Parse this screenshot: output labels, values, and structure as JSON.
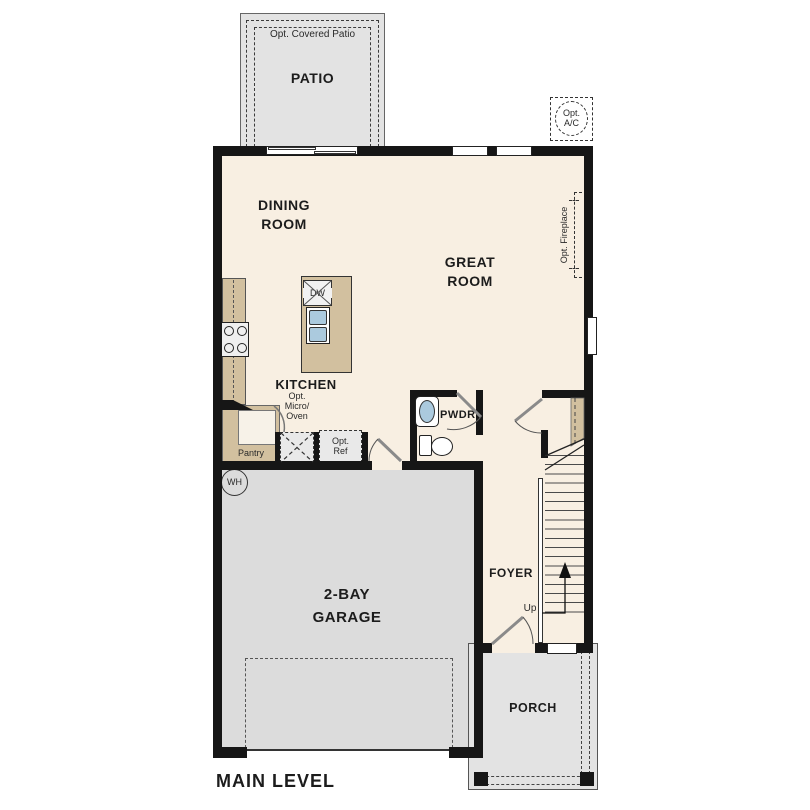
{
  "plan": {
    "title": "MAIN LEVEL",
    "rooms": {
      "patio": {
        "name": "PATIO",
        "option": "Opt. Covered Patio"
      },
      "dining_room": {
        "line1": "DINING",
        "line2": "ROOM"
      },
      "great_room": {
        "line1": "GREAT",
        "line2": "ROOM"
      },
      "kitchen": {
        "name": "KITCHEN"
      },
      "pantry": {
        "name": "Pantry"
      },
      "powder_room": {
        "name": "PWDR"
      },
      "foyer": {
        "name": "FOYER"
      },
      "garage": {
        "line1": "2-BAY",
        "line2": "GARAGE"
      },
      "porch": {
        "name": "PORCH"
      }
    },
    "features": {
      "opt_ac": {
        "line1": "Opt.",
        "line2": "A/C"
      },
      "opt_fireplace": "Opt. Fireplace",
      "opt_micro_oven": {
        "line1": "Opt.",
        "line2": "Micro/",
        "line3": "Oven"
      },
      "opt_ref": {
        "line1": "Opt.",
        "line2": "Ref"
      },
      "dishwasher": "DW",
      "water_heater": "WH",
      "stairs_up": "Up"
    },
    "colors": {
      "wall": "#161616",
      "floor": "#f8efe2",
      "counter_tan": "#d2c09f",
      "patio_porch_gray": "#e3e3e3",
      "garage_gray": "#dcdcdc",
      "fixture_blue": "#abcade"
    }
  }
}
